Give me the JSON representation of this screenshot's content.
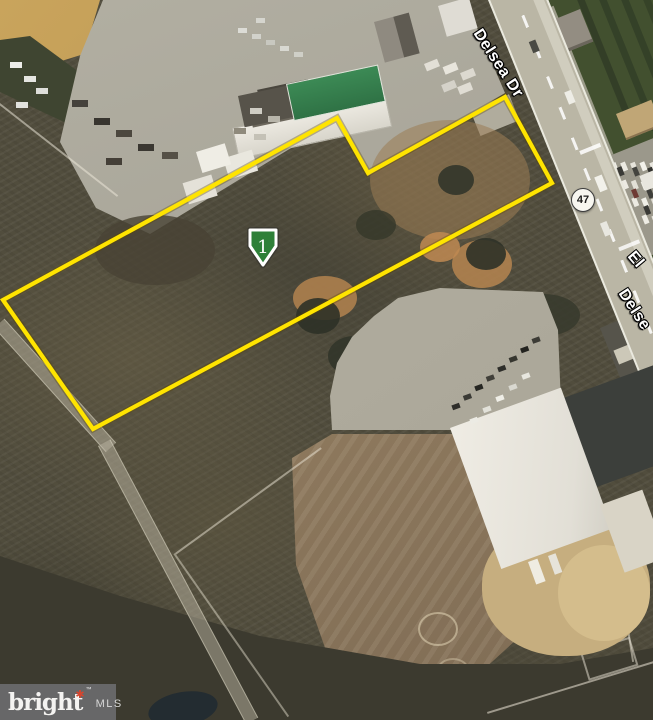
{
  "roads": {
    "main": "Delsea Dr",
    "main_partial": "Delse",
    "cross_partial": "El",
    "route": "47"
  },
  "parcel": {
    "outline_color": "#FFE400",
    "points": "337,118 368,173 505,97 552,183 93,429 3,300",
    "marker": {
      "label": "1",
      "color": "#2E8038",
      "x": 263,
      "y": 248
    }
  },
  "watermark": {
    "brand": "bright",
    "star": "✱",
    "tm": "™",
    "suffix": "MLS"
  }
}
